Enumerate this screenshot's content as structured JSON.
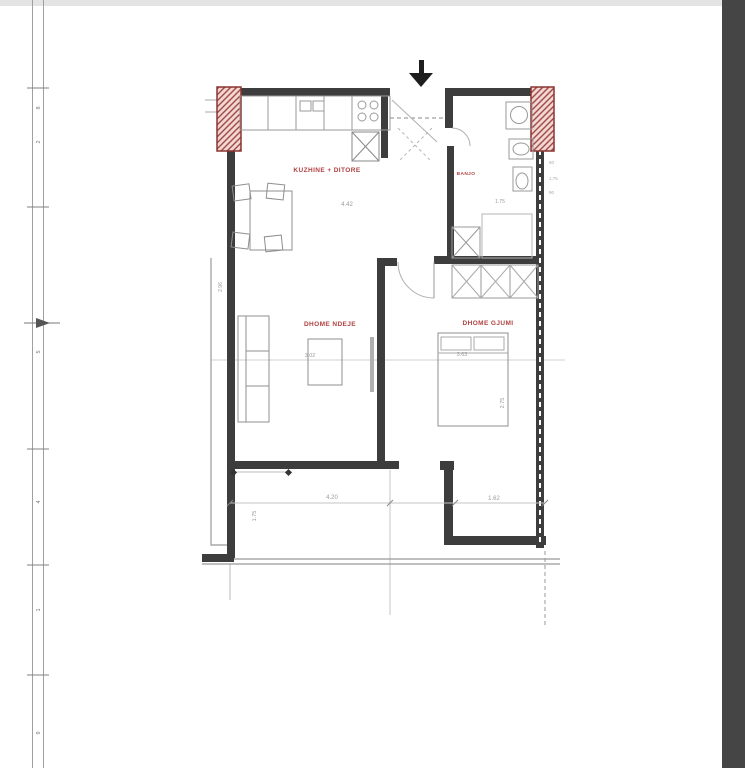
{
  "window": {
    "top_strip_color": "#e4e4e4",
    "right_strip_color": "#454545",
    "page_bg": "#ffffff"
  },
  "ruler": {
    "tick_labels": [
      "8",
      "2",
      "5",
      "4",
      "1",
      "9"
    ]
  },
  "plan": {
    "labels": {
      "kitchen_living": "KUZHINE + DITORE",
      "living_room": "DHOME NDEJE",
      "bedroom": "DHOME GJUMI",
      "bathroom": "BANJO"
    },
    "dimensions": {
      "kitchen_width": "4.42",
      "bathroom_width": "1.75",
      "living_width": "3.02",
      "bedroom_width": "3.63",
      "bedroom_depth": "2.75",
      "bottom_left": "4.20",
      "bottom_right": "1.62",
      "balcony_depth": "1.75",
      "left_wall": "2.96",
      "right_side": [
        "60",
        "1.75",
        "90"
      ]
    },
    "colors": {
      "wall": "#3d3d3d",
      "hatch_fill": "#f1d6d3",
      "hatch_stroke": "#a04a44",
      "column_border": "#8a3531",
      "label_red": "#b04040",
      "dim_gray": "#9a9a9a"
    }
  }
}
